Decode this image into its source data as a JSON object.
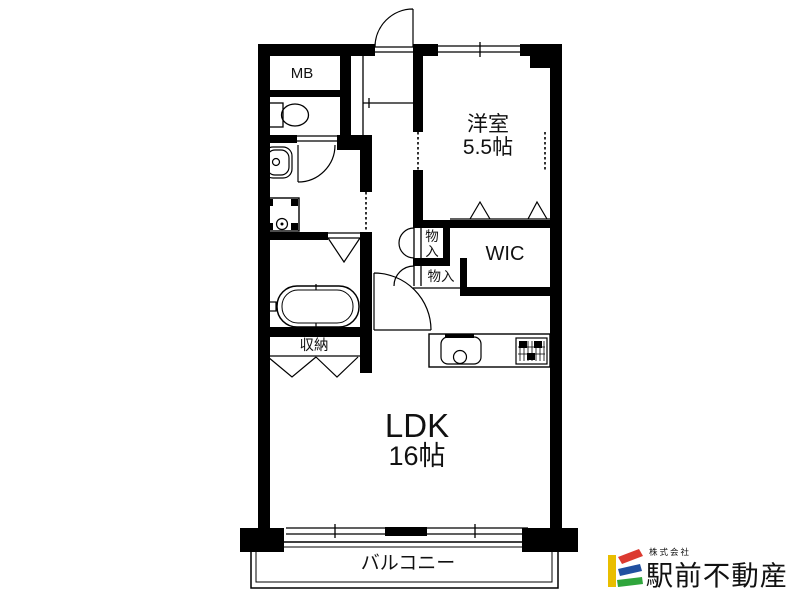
{
  "floorplan": {
    "rooms": {
      "mb": "MB",
      "bedroom": "洋室",
      "bedroom_size": "5.5帖",
      "closet_upper_l1": "物",
      "closet_upper_l2": "入",
      "wic": "WIC",
      "closet_lower": "物入",
      "storage": "収納",
      "ldk": "LDK",
      "ldk_size": "16帖",
      "balcony": "バルコニー"
    }
  },
  "logo": {
    "prefix": "株式会社",
    "name": "駅前不動産",
    "colors": {
      "yellow": "#E9BE00",
      "red": "#DC3A30",
      "blue": "#2150A0",
      "green": "#2FA53C",
      "text": "#8E8E8E"
    }
  }
}
